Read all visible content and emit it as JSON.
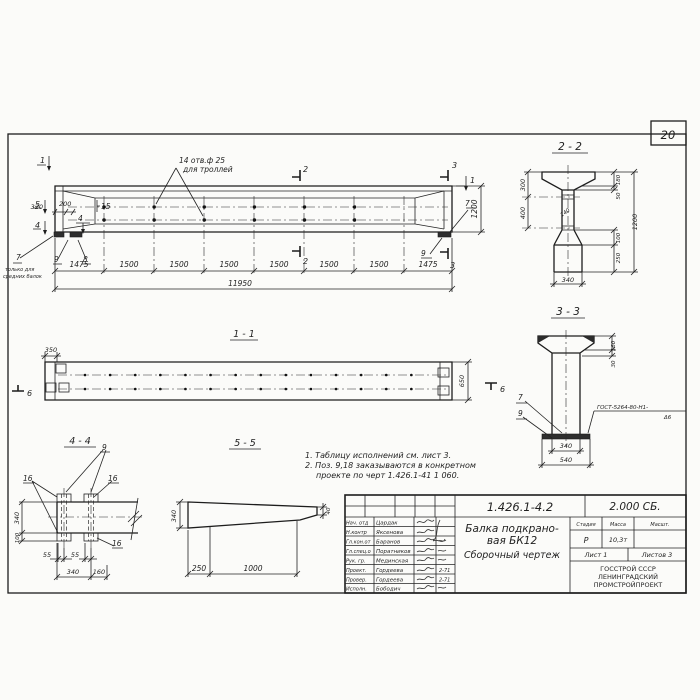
{
  "page": {
    "number": "20"
  },
  "main_view": {
    "hole_note_1": "14 отв.ф 25",
    "hole_note_2": "для троллей",
    "sec1_left": "1",
    "sec5_left": "5",
    "sec4_left": "4",
    "sec2_top": "2",
    "sec2_bot": "2",
    "sec3_top": "3",
    "sec3_bot": "3",
    "sec1_right": "1",
    "dim_320": "320",
    "dim_200": "200",
    "dim_1200": "1200",
    "pos_15": "15",
    "pos_4": "4",
    "pos_7": "7",
    "pos_8": "8",
    "pos_9": "9",
    "pos_7_right": "7",
    "pos_9_right": "9",
    "note7_1": "только для",
    "note7_2": "средних балок",
    "segments": [
      "1475",
      "1500",
      "1500",
      "1500",
      "1500",
      "1500",
      "1500",
      "1475"
    ],
    "dim_total": "11950"
  },
  "section22": {
    "title": "2 - 2",
    "d300": "300",
    "d400": "400",
    "d180": "180",
    "d50": "50",
    "d140": "140",
    "d1200": "1200",
    "d100": "100",
    "d250": "250",
    "d340": "340"
  },
  "section33": {
    "title": "3 - 3",
    "d160": "160",
    "d30": "30",
    "d340": "340",
    "d540": "540",
    "pos7": "7",
    "pos9": "9",
    "weld1": "ГОСТ-5264-80-Н1-",
    "weld2": "Δ6"
  },
  "view11": {
    "title": "1 - 1",
    "d350": "350",
    "d650": "650",
    "m6_left": "6",
    "m6_right": "6"
  },
  "view44": {
    "title": "4 - 4",
    "pos9": "9",
    "pos16_a": "16",
    "pos16_b": "16",
    "pos16_c": "16",
    "d340v": "340",
    "d100": "100",
    "d55a": "55",
    "d55b": "55",
    "d340h": "340",
    "d160": "160"
  },
  "view55": {
    "title": "5 - 5",
    "d340": "340",
    "d250": "250",
    "d1000": "1000",
    "d40": "40"
  },
  "notes": {
    "line1": "1. Таблицу исполнений см. лист 3.",
    "line2": "2. Поз. 9,18 заказываются в конкретном",
    "line3": "проекте по черт 1.426.1-41 1 060."
  },
  "title_block": {
    "doc_number": "1.426.1-4.2",
    "doc_code": "2.000 СБ.",
    "title1": "Балка подкрано-",
    "title2": "вая БК12",
    "title3": "Сборочный чертеж",
    "h_stage": "Стадия",
    "h_mass": "Масса",
    "h_scale": "Масшт.",
    "v_stage": "Р",
    "v_mass": "10,3т",
    "sheet": "Лист 1",
    "sheets": "Листов 3",
    "org1": "ГОССТРОЙ СССР",
    "org2": "ЛЕНИНГРАДСКИЙ",
    "org3": "ПРОМСТРОЙПРОЕКТ",
    "rows": [
      {
        "role": "Нач. отд",
        "name": "Цардак",
        "date": ""
      },
      {
        "role": "Н.контр",
        "name": "Яксенова",
        "date": ""
      },
      {
        "role": "Гл.кон.от",
        "name": "Баранов",
        "date": ""
      },
      {
        "role": "Гл.спец.о",
        "name": "Поратников",
        "date": ""
      },
      {
        "role": "Рук. гр.",
        "name": "Мединская",
        "date": ""
      },
      {
        "role": "Проект.",
        "name": "Гордеева",
        "date": "2-71"
      },
      {
        "role": "Провер.",
        "name": "Гордеева",
        "date": "2-71"
      },
      {
        "role": "Исполн.",
        "name": "Бободич",
        "date": ""
      }
    ]
  }
}
